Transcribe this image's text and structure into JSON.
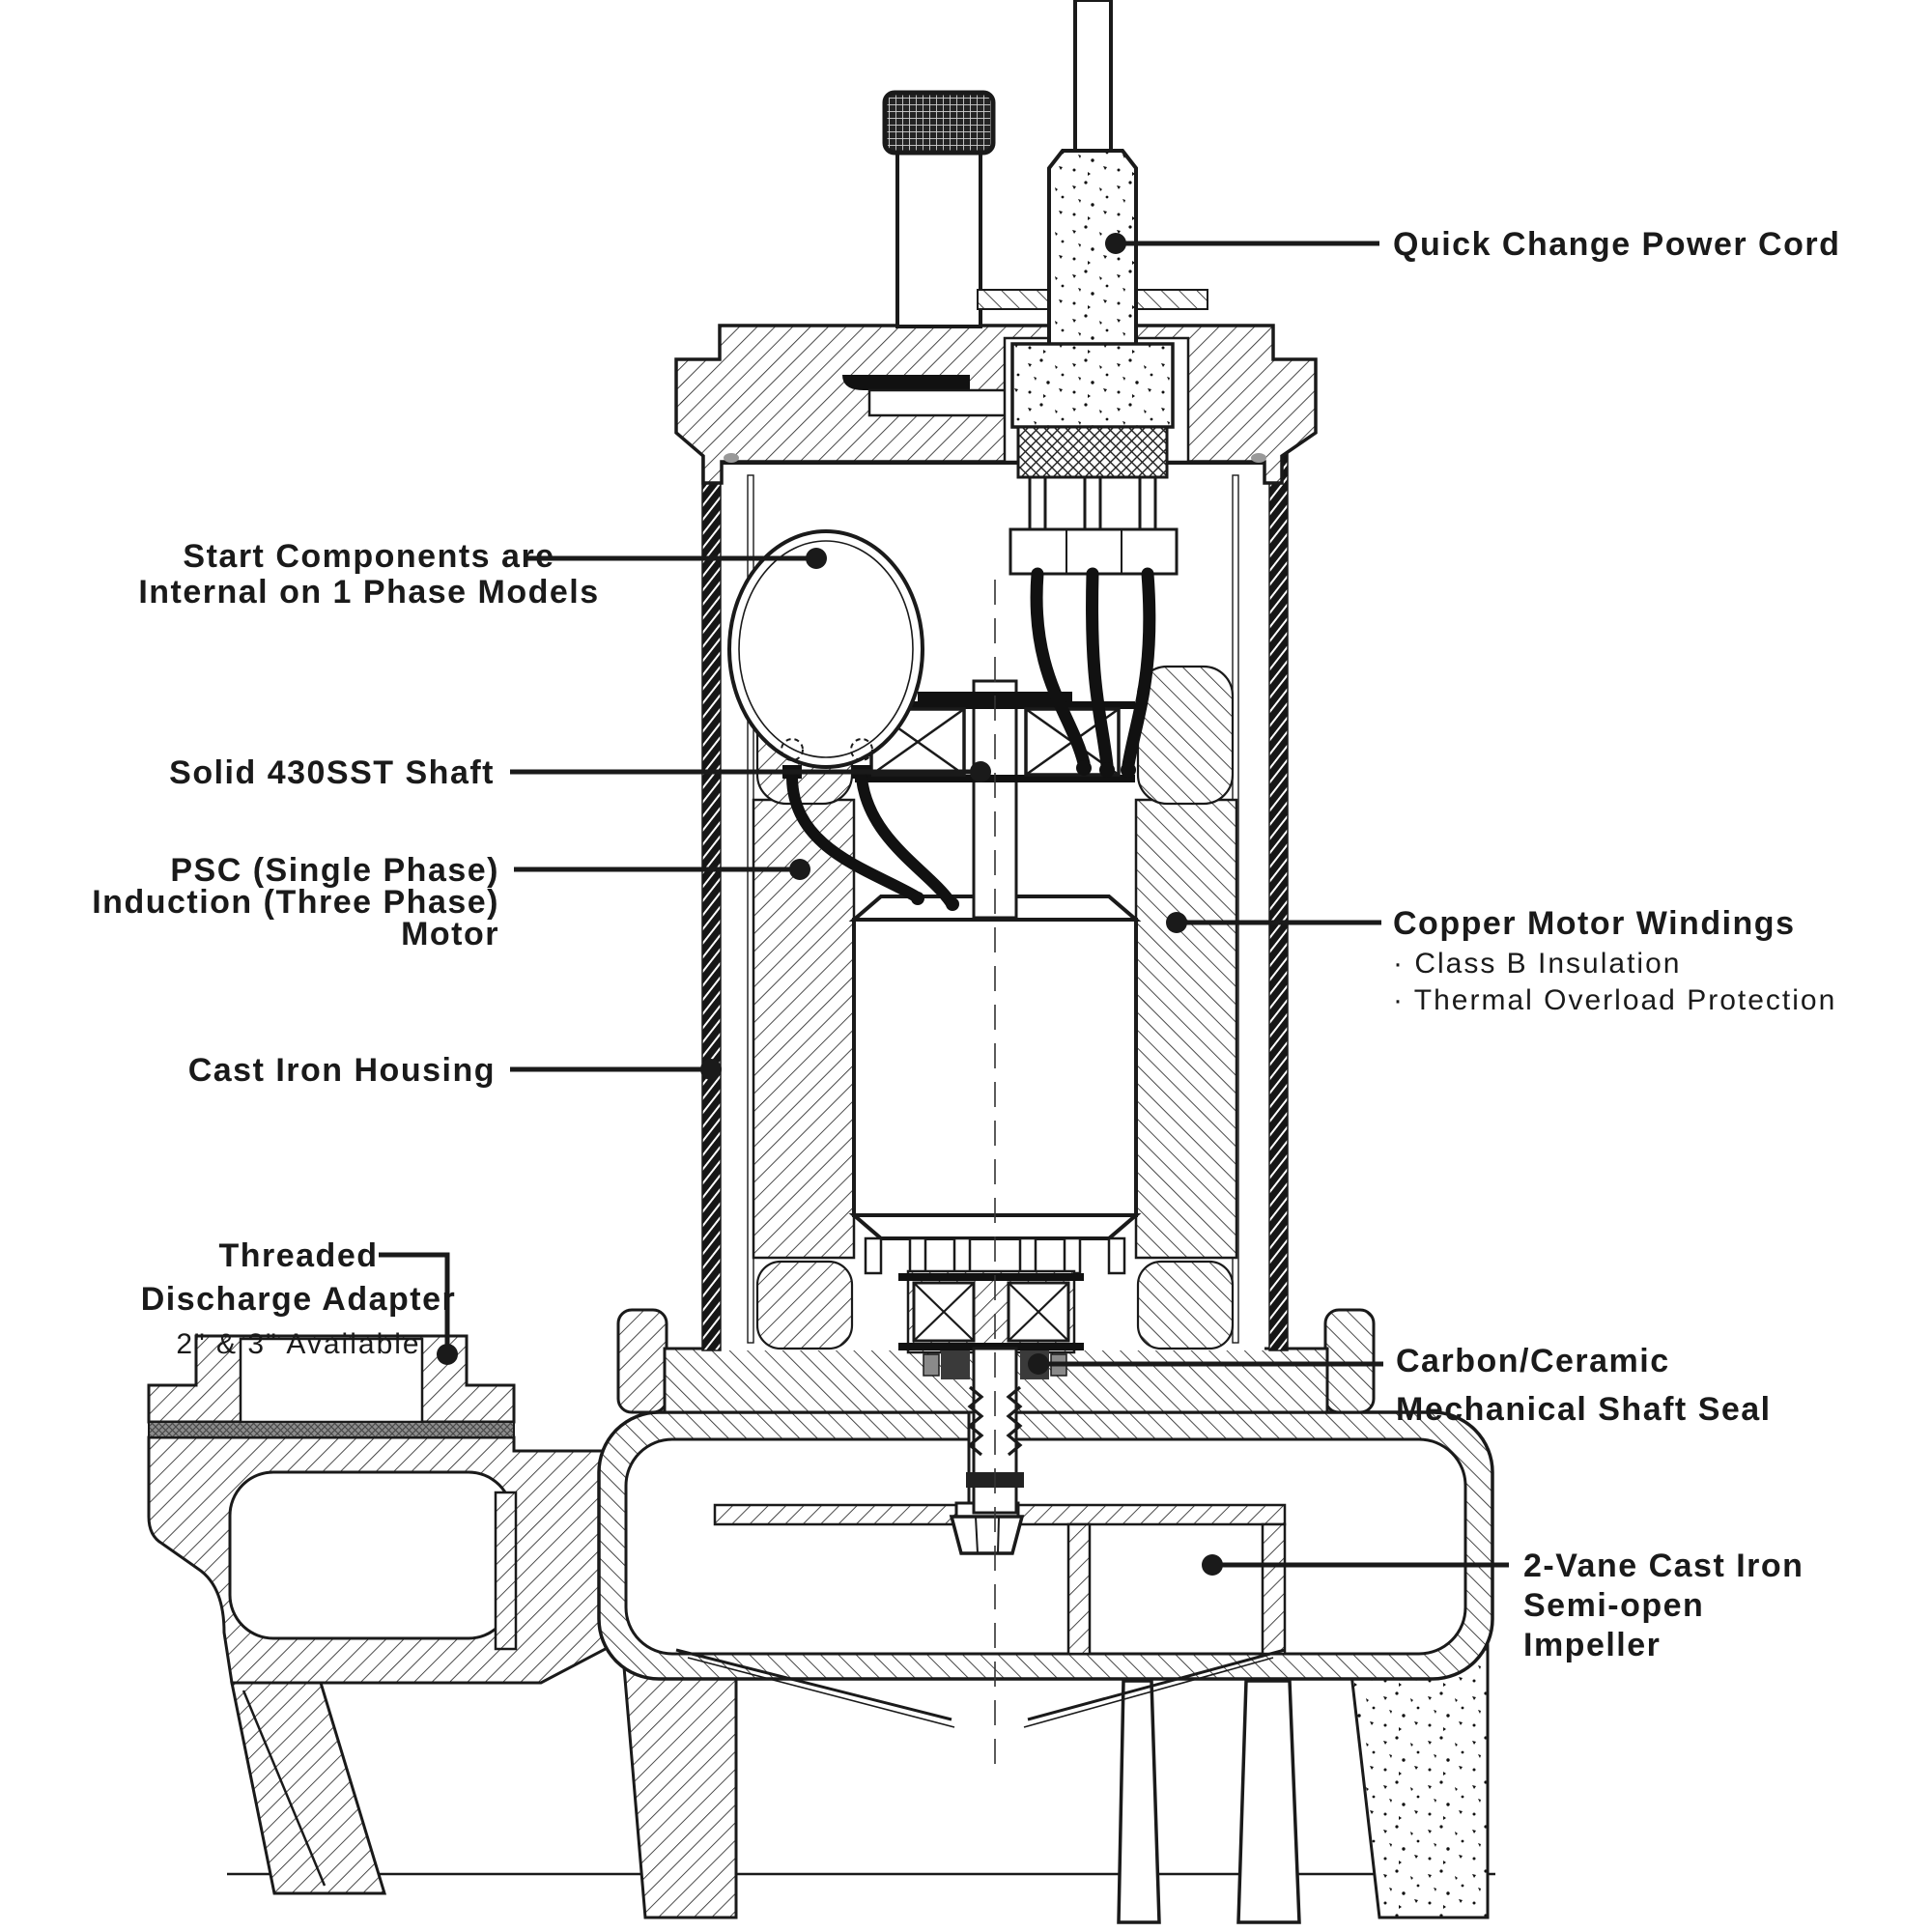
{
  "diagram": {
    "type": "cutaway-technical-line-drawing",
    "subject": "Submersible sewage pump cross-section with callouts",
    "colors": {
      "ink": "#1a1a1a",
      "background": "#ffffff"
    },
    "labels": {
      "power_cord": {
        "lines": [
          "Quick Change Power Cord"
        ]
      },
      "start_components": {
        "lines": [
          "Start Components are",
          "Internal on 1 Phase Models"
        ]
      },
      "shaft": {
        "lines": [
          "Solid 430SST Shaft"
        ]
      },
      "motor": {
        "lines": [
          "PSC (Single Phase)",
          "Induction (Three Phase)",
          "Motor"
        ]
      },
      "housing": {
        "lines": [
          "Cast Iron Housing"
        ]
      },
      "discharge_adapter": {
        "lines": [
          "Threaded",
          "Discharge Adapter",
          "2\" & 3\" Available"
        ]
      },
      "windings": {
        "title": "Copper Motor Windings",
        "bullets": [
          "· Class B Insulation",
          "· Thermal Overload Protection"
        ]
      },
      "shaft_seal": {
        "lines": [
          "Carbon/Ceramic",
          "Mechanical Shaft Seal"
        ]
      },
      "impeller": {
        "lines": [
          "2-Vane Cast Iron",
          "Semi-open",
          "Impeller"
        ]
      }
    }
  }
}
